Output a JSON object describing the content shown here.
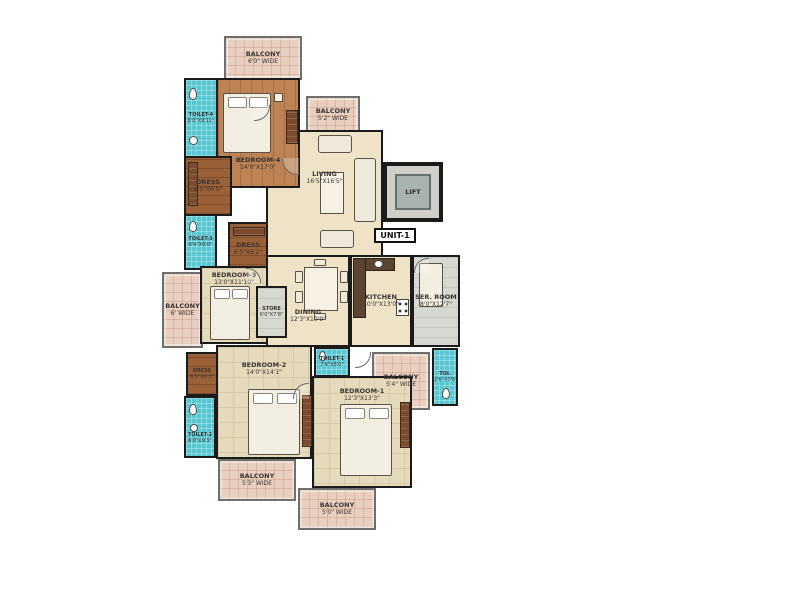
{
  "plan": {
    "unit_label": "UNIT-1",
    "lift_label": "LIFT",
    "rooms": {
      "bedroom4": {
        "name": "BEDROOM-4",
        "dims": "14'0\"X17'0\""
      },
      "bedroom3": {
        "name": "BEDROOM-3",
        "dims": "13'0\"X11'10\""
      },
      "bedroom2": {
        "name": "BEDROOM-2",
        "dims": "14'0\"X14'1\""
      },
      "bedroom1": {
        "name": "BEDROOM-1",
        "dims": "12'3\"X13'3\""
      },
      "living": {
        "name": "LIVING",
        "dims": "16'5\"X16'5\""
      },
      "dining": {
        "name": "DINING",
        "dims": "12'3\"X10'9\""
      },
      "kitchen": {
        "name": "KITCHEN",
        "dims": "10'0\"X13'0\""
      },
      "ser_room": {
        "name": "SER. ROOM",
        "dims": "8'0\"X12'7\""
      },
      "store": {
        "name": "STORE",
        "dims": "6'0\"X7'8\""
      },
      "toilet1": {
        "name": "TOILET-1",
        "dims": "7'4\"X6'0\""
      },
      "toilet2": {
        "name": "TOILET-2",
        "dims": "6'0\"X9'3\""
      },
      "toilet3": {
        "name": "TOILET-3",
        "dims": "8'4\"X6'0\""
      },
      "toilet4": {
        "name": "TOILET-4",
        "dims": "6'0\"X9'11\""
      },
      "toi_ser": {
        "name": "TOI.",
        "dims": "2'6\"X7'6\""
      },
      "dress4": {
        "name": "DRESS",
        "dims": "6'0\"X6'0\""
      },
      "dress3": {
        "name": "DRESS",
        "dims": "6'5\"X6'2\""
      },
      "dress2": {
        "name": "DRESS",
        "dims": "6'0\"X6'3\""
      }
    },
    "balconies": {
      "top": {
        "name": "BALCONY",
        "dims": "6'0\" WIDE"
      },
      "living": {
        "name": "BALCONY",
        "dims": "5'2\" WIDE"
      },
      "left": {
        "name": "BALCONY",
        "dims": "6' WIDE"
      },
      "right": {
        "name": "BALCONY",
        "dims": "5'4\" WIDE"
      },
      "bottom_left": {
        "name": "BALCONY",
        "dims": "5'3\" WIDE"
      },
      "bottom_center": {
        "name": "BALCONY",
        "dims": "5'0\" WIDE"
      }
    },
    "colors": {
      "wall": "#1b1b1b",
      "toilet_floor": "#59c7d2",
      "wood_floor": "#bd8355",
      "dress_floor": "#9a6038",
      "tile_floor": "#e6dabc",
      "cream_floor": "#eee3c6",
      "balcony_floor": "#e8cfbf",
      "ser_room_floor": "#d8d8d2",
      "lift_floor": "#a9b3ad"
    }
  }
}
